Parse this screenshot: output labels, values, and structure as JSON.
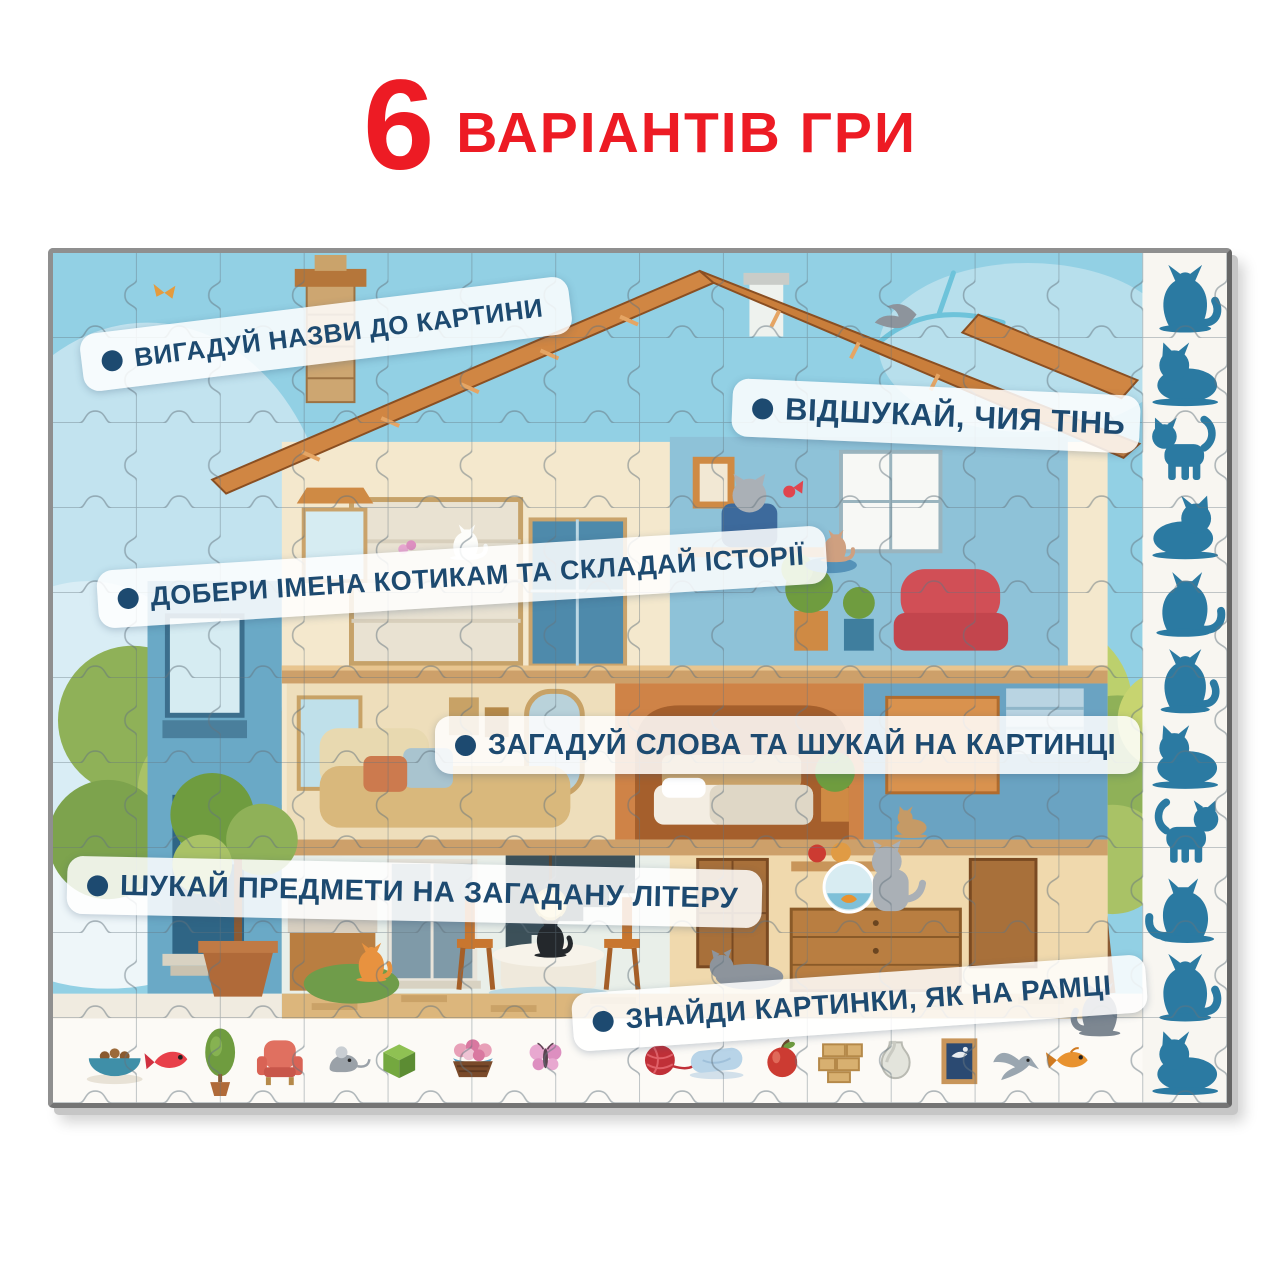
{
  "title": {
    "count": "6",
    "label": "ВАРІАНТІВ ГРИ",
    "color": "#ed1b24"
  },
  "banners": [
    {
      "label": "ВИГАДУЙ НАЗВИ ДО КАРТИНИ"
    },
    {
      "label": "ВІДШУКАЙ, ЧИЯ ТІНЬ"
    },
    {
      "label": "ДОБЕРИ ІМЕНА КОТИКАМ ТА СКЛАДАЙ ІСТОРІЇ"
    },
    {
      "label": "ЗАГАДУЙ СЛОВА ТА ШУКАЙ НА КАРТИНЦІ"
    },
    {
      "label": "ШУКАЙ ПРЕДМЕТИ НА ЗАГАДАНУ ЛІТЕРУ"
    },
    {
      "label": "ЗНАЙДИ КАРТИНКИ, ЯК НА РАМЦІ"
    }
  ],
  "banner_style": {
    "text_color": "#1d4a70",
    "background": "rgba(255,255,255,0.85)"
  },
  "puzzle": {
    "scene": "cutaway-house-with-cats-jigsaw",
    "shadow_strip": {
      "cat_shadow_count": 11,
      "color": "#2b7aa2"
    },
    "frame_items": [
      "food-bowl",
      "red-fish",
      "potted-tree",
      "armchair",
      "mouse",
      "green-box",
      "flower-basket",
      "butterfly",
      "yarn-ball",
      "pillow",
      "apple",
      "bricks",
      "vase",
      "picture-frame",
      "dove",
      "goldfish"
    ]
  }
}
